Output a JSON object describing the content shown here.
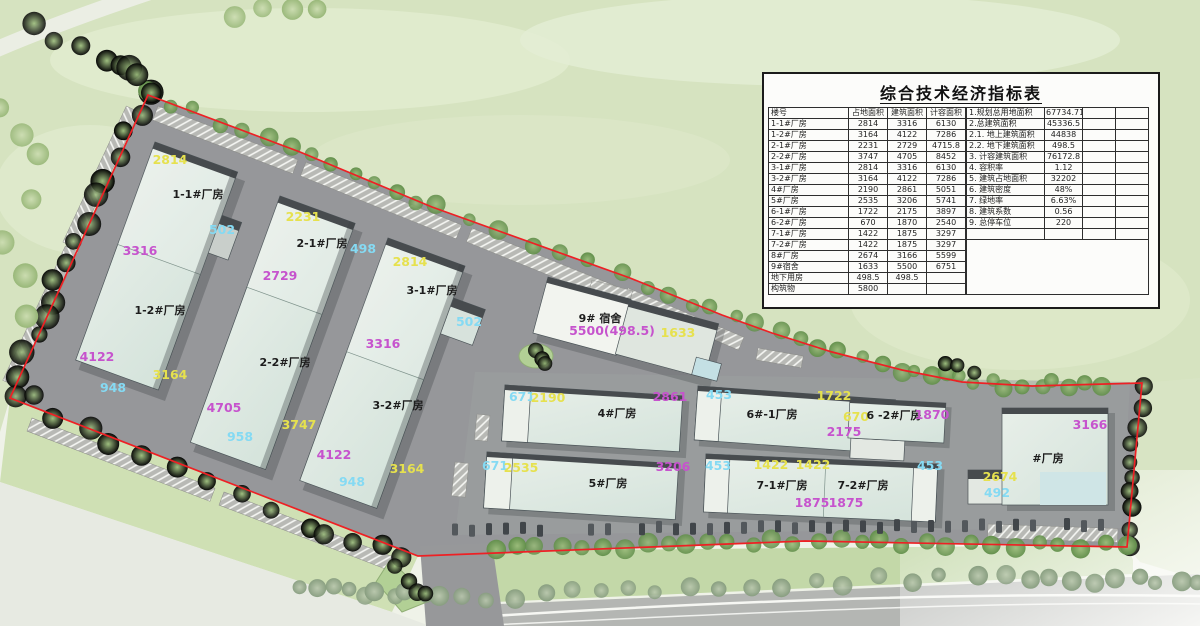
{
  "table": {
    "title": "综合技术经济指标表",
    "left": {
      "headers": [
        "楼号",
        "占地面积",
        "建筑面积",
        "计容面积"
      ],
      "rows": [
        [
          "1-1#厂房",
          "2814",
          "3316",
          "6130"
        ],
        [
          "1-2#厂房",
          "3164",
          "4122",
          "7286"
        ],
        [
          "2-1#厂房",
          "2231",
          "2729",
          "4715.8"
        ],
        [
          "2-2#厂房",
          "3747",
          "4705",
          "8452"
        ],
        [
          "3-1#厂房",
          "2814",
          "3316",
          "6130"
        ],
        [
          "3-2#厂房",
          "3164",
          "4122",
          "7286"
        ],
        [
          "4#厂房",
          "2190",
          "2861",
          "5051"
        ],
        [
          "5#厂房",
          "2535",
          "3206",
          "5741"
        ],
        [
          "6-1#厂房",
          "1722",
          "2175",
          "3897"
        ],
        [
          "6-2#厂房",
          "670",
          "1870",
          "2540"
        ],
        [
          "7-1#厂房",
          "1422",
          "1875",
          "3297"
        ],
        [
          "7-2#厂房",
          "1422",
          "1875",
          "3297"
        ],
        [
          "8#厂房",
          "2674",
          "3166",
          "5599"
        ],
        [
          "9#宿舍",
          "1633",
          "5500",
          "6751"
        ],
        [
          "地下用房",
          "498.5",
          "498.5",
          ""
        ],
        [
          "构筑物",
          "5800",
          "",
          ""
        ]
      ]
    },
    "right": {
      "rows": [
        [
          "1.规划总用地面积",
          "67734.71"
        ],
        [
          "2.总建筑面积",
          "45336.5"
        ],
        [
          "2.1. 地上建筑面积",
          "44838"
        ],
        [
          "2.2. 地下建筑面积",
          "498.5"
        ],
        [
          "3. 计容建筑面积",
          "76172.8"
        ],
        [
          "4. 容积率",
          "1.12"
        ],
        [
          "5. 建筑占地面积",
          "32202"
        ],
        [
          "6. 建筑密度",
          "48%"
        ],
        [
          "7. 绿地率",
          "6.63%"
        ],
        [
          "8. 建筑系数",
          "0.56"
        ],
        [
          "9. 总停车位",
          "220"
        ]
      ]
    }
  },
  "plan": {
    "annotations": [
      {
        "t": "2814"
      },
      {
        "t": "1-1#厂房"
      },
      {
        "t": "502"
      },
      {
        "t": "3316"
      },
      {
        "t": "1-2#厂房"
      },
      {
        "t": "4122"
      },
      {
        "t": "3164"
      },
      {
        "t": "948"
      },
      {
        "t": "2231"
      },
      {
        "t": "2-1#厂房"
      },
      {
        "t": "498"
      },
      {
        "t": "2729"
      },
      {
        "t": "2-2#厂房"
      },
      {
        "t": "4705"
      },
      {
        "t": "3747"
      },
      {
        "t": "958"
      },
      {
        "t": "2814"
      },
      {
        "t": "3-1#厂房"
      },
      {
        "t": "502"
      },
      {
        "t": "3316"
      },
      {
        "t": "3-2#厂房"
      },
      {
        "t": "4122"
      },
      {
        "t": "3164"
      },
      {
        "t": "948"
      },
      {
        "t": "9# 宿舍"
      },
      {
        "t": "5500(498.5)"
      },
      {
        "t": "1633"
      },
      {
        "t": "671"
      },
      {
        "t": "2190"
      },
      {
        "t": "2861"
      },
      {
        "t": "4#厂房"
      },
      {
        "t": "453"
      },
      {
        "t": "1722"
      },
      {
        "t": "6#-1厂房"
      },
      {
        "t": "670"
      },
      {
        "t": "2175"
      },
      {
        "t": "6 -2#厂房"
      },
      {
        "t": "1870"
      },
      {
        "t": "671"
      },
      {
        "t": "2535"
      },
      {
        "t": "3206"
      },
      {
        "t": "5#厂房"
      },
      {
        "t": "453"
      },
      {
        "t": "1422"
      },
      {
        "t": "1422"
      },
      {
        "t": "7-1#厂房"
      },
      {
        "t": "7-2#厂房"
      },
      {
        "t": "1875"
      },
      {
        "t": "1875"
      },
      {
        "t": "453"
      },
      {
        "t": "3166"
      },
      {
        "t": "#厂房"
      },
      {
        "t": "2674"
      },
      {
        "t": "492"
      }
    ],
    "boundary_color": "#ee2024",
    "dim_colors": {
      "footprint_yellow": "#e6e14e",
      "built_magenta": "#c653cd",
      "annex_cyan": "#85daf3"
    }
  }
}
